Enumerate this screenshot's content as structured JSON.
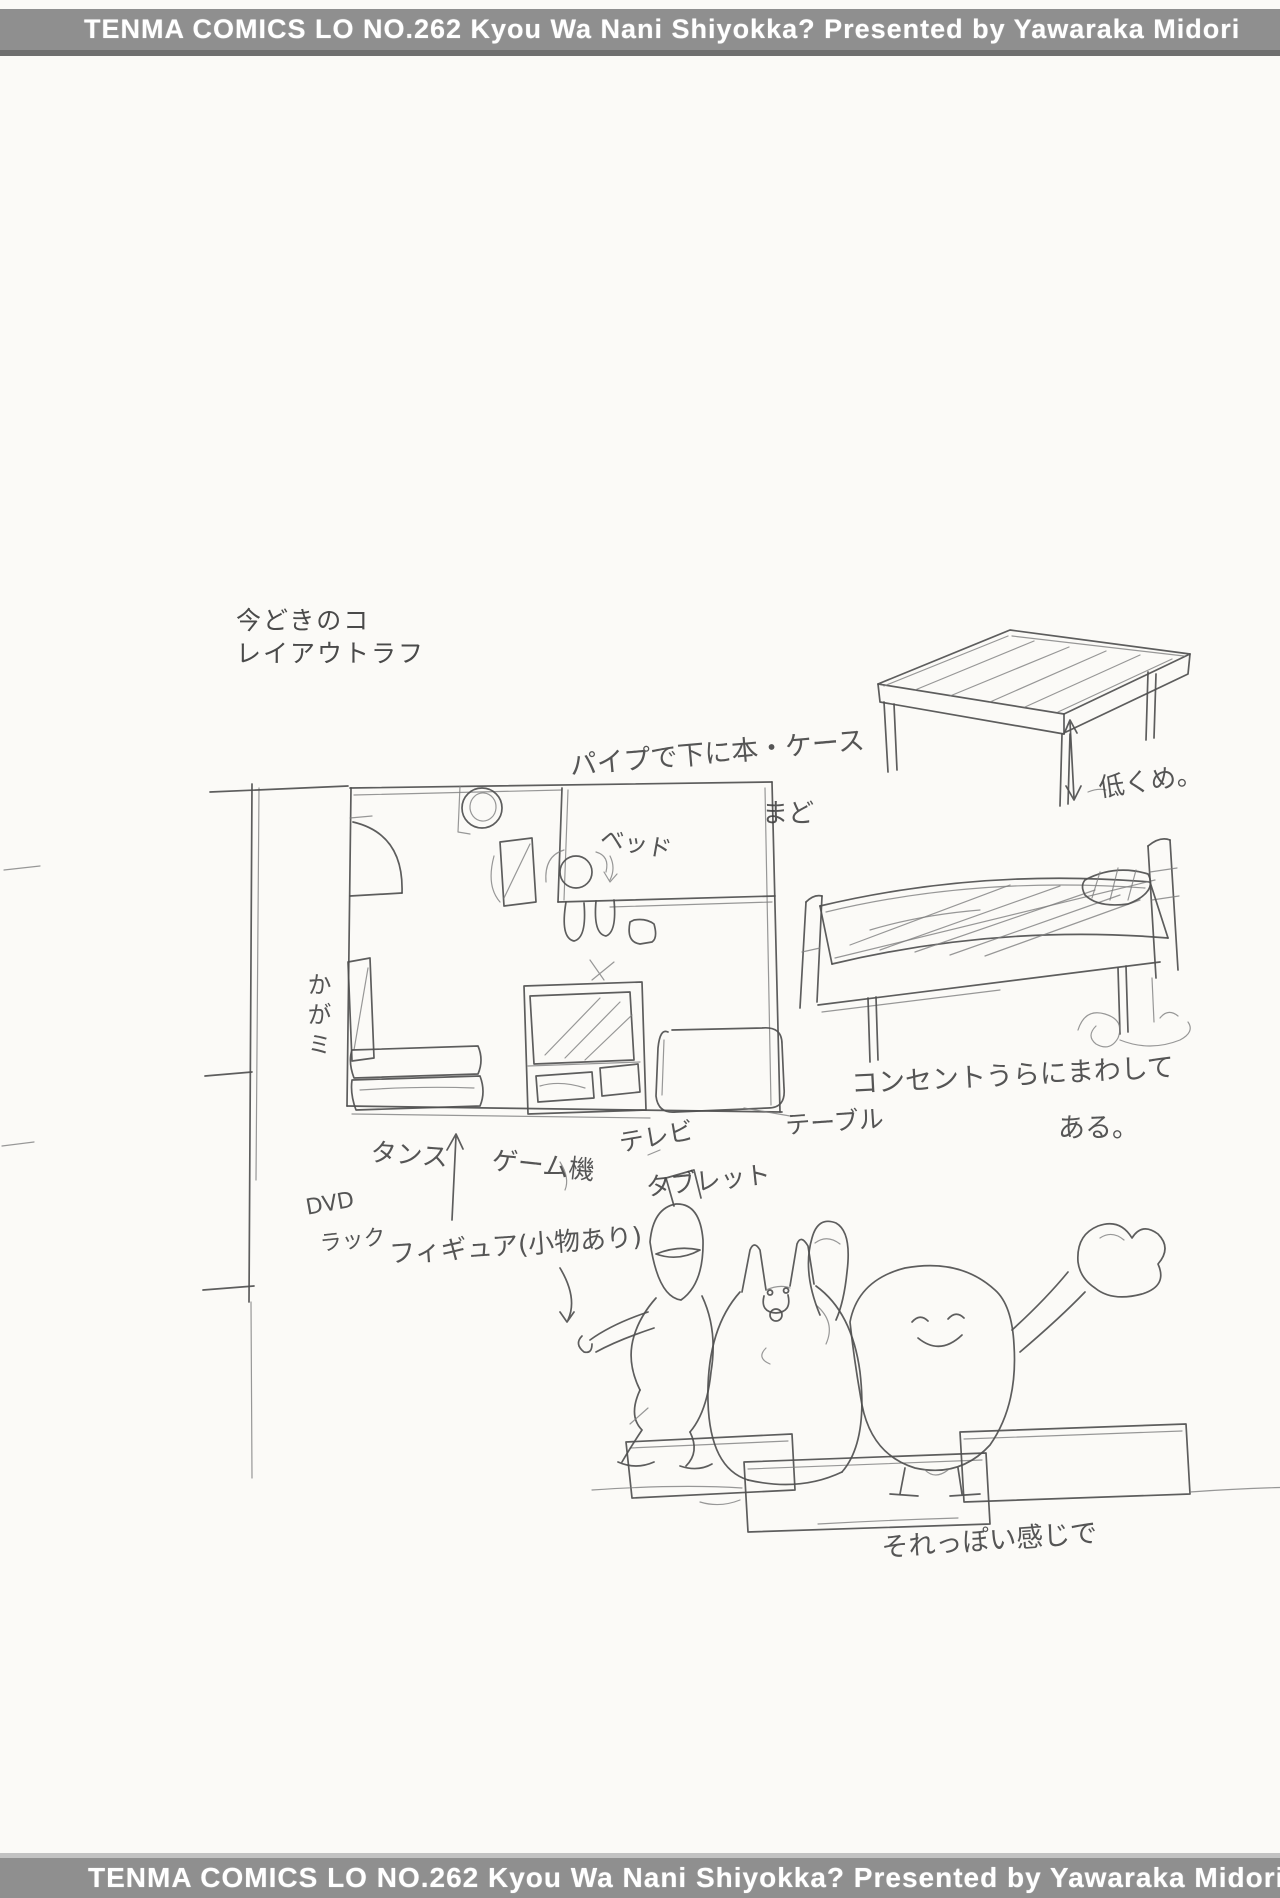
{
  "banner": {
    "text": "TENMA COMICS LO NO.262 Kyou Wa Nani Shiyokka? Presented by Yawaraka Midori"
  },
  "caption": {
    "line1": "今どきのコ",
    "line2": "レイアウトラフ"
  },
  "annotations": {
    "pipe_note": "パイプで下に本・ケース",
    "window": "まど",
    "bed": "ベッド",
    "mirror": "かがミ",
    "dresser": "タンス",
    "game_console": "ゲーム機",
    "tv": "テレビ",
    "tablet": "タブレット",
    "table": "テーブル",
    "dvd": "DVD",
    "rack": "ラック",
    "figures": "フィギュア(小物あり)",
    "low": "低くめ。",
    "outlet_line1": "コンセントうらにまわして",
    "outlet_line2": "ある。",
    "style_note": "それっぽい感じで"
  },
  "colors": {
    "paper": "#fbfaf7",
    "banner_bg": "#8f8f8f",
    "banner_edge": "#6f6f6f",
    "banner_text": "#ffffff",
    "ink": "#4f4f4f"
  }
}
